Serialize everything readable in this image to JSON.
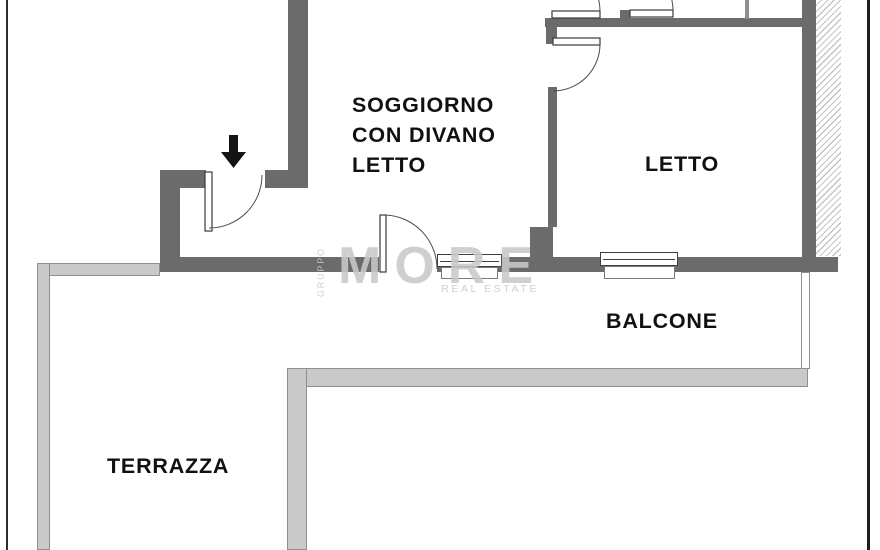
{
  "rooms": {
    "soggiorno": "SOGGIORNO\nCON DIVANO\nLETTO",
    "letto": "LETTO",
    "balcone": "BALCONE",
    "terrazza": "TERRAZZA"
  },
  "watermark": {
    "group": "GRUPPO",
    "brand": "MORE",
    "tagline": "REAL ESTATE"
  },
  "icons": {
    "entrance_arrow": "down-arrow"
  },
  "colors": {
    "wall": "#6b6b6b",
    "parapet_fill": "#c9c9c9",
    "parapet_line": "#8f8f8f",
    "hatch_line": "#c5c5c5",
    "watermark": "#c9c9c9",
    "ink": "#111111"
  }
}
